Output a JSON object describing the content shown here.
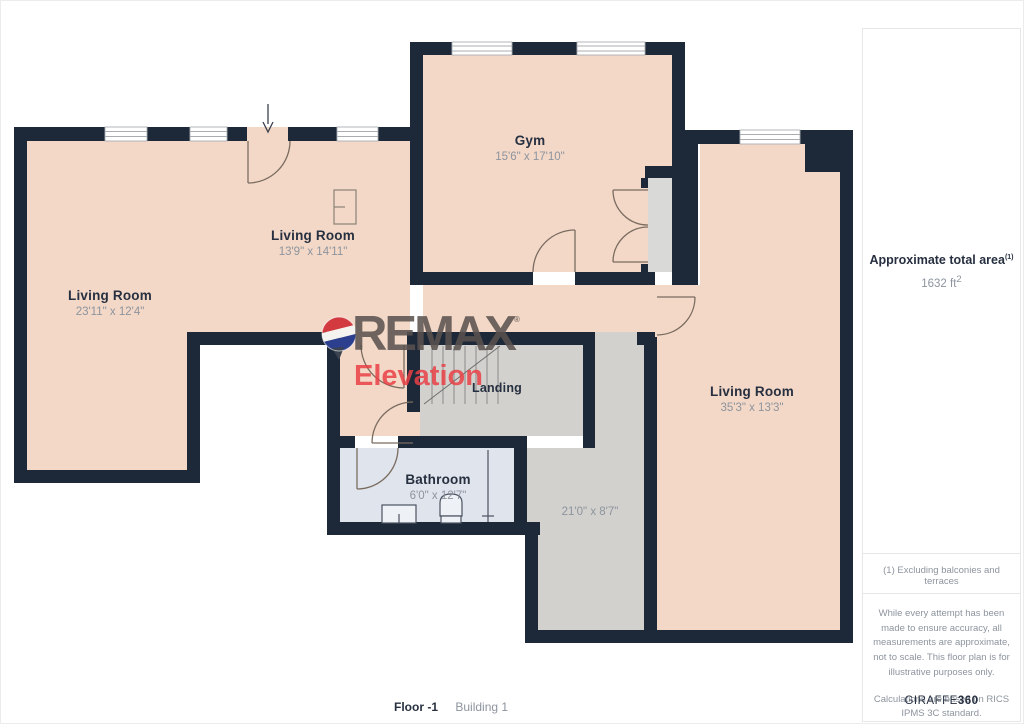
{
  "floorplan": {
    "rooms": [
      {
        "id": "gym",
        "name": "Gym",
        "dims": "15'6\" x 17'10\""
      },
      {
        "id": "living-mid",
        "name": "Living Room",
        "dims": "13'9\" x 14'11\""
      },
      {
        "id": "living-left",
        "name": "Living Room",
        "dims": "23'11\" x 12'4\""
      },
      {
        "id": "living-right",
        "name": "Living Room",
        "dims": "35'3\" x 13'3\""
      },
      {
        "id": "landing",
        "name": "Landing",
        "dims": ""
      },
      {
        "id": "bathroom",
        "name": "Bathroom",
        "dims": "6'0\" x 12'7\""
      },
      {
        "id": "corridor",
        "name": "",
        "dims": "21'0\" x 8'7\""
      }
    ],
    "logo": {
      "brand": "REMAX",
      "registered": "®",
      "sub": "Elevation"
    },
    "colors": {
      "wall": "#1d2838",
      "room_fill": "#f3d8c7",
      "landing_fill": "#d2d1ce",
      "bathroom_fill": "#e0e4ec",
      "brand_gray": "#5a524e",
      "brand_red": "#e94045"
    },
    "footer": {
      "floor_label": "Floor -1",
      "building_label": "Building 1"
    }
  },
  "sidebar": {
    "area_title": "Approximate total area",
    "area_sup": "(1)",
    "area_value": "1632 ft",
    "area_value_sup": "2",
    "footnote": "(1) Excluding balconies and terraces",
    "disclaimer1": "While every attempt has been made to ensure accuracy, all measurements are approximate, not to scale. This floor plan is for illustrative purposes only.",
    "disclaimer2": "Calculations are based on RICS IPMS 3C standard.",
    "brand_normal": "GIRAFFE",
    "brand_bold": "360"
  }
}
